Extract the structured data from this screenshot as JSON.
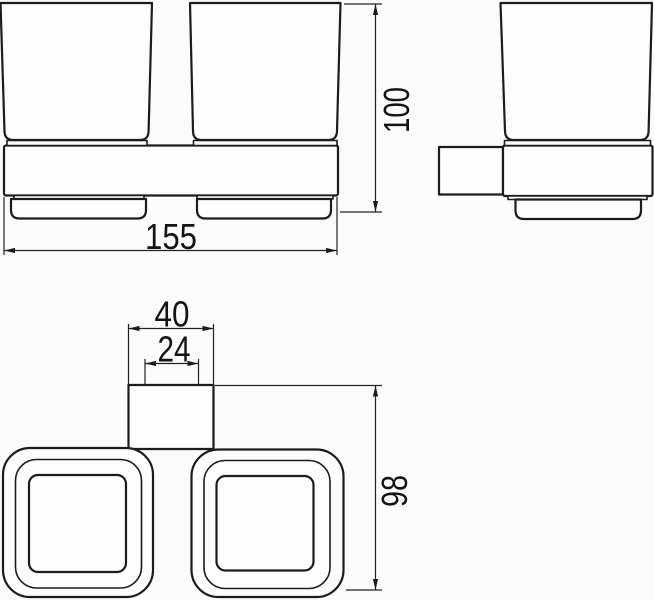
{
  "drawing": {
    "type": "technical-dimension-drawing",
    "subject": "double-tumbler-holder",
    "views": {
      "front_view": "top-left",
      "side_view": "top-right",
      "plan_view": "bottom"
    },
    "colors": {
      "background": "#fbfbfb",
      "object_line": "#1c1c1c",
      "dimension_line": "#222222",
      "text": "#141414"
    },
    "dimensions": {
      "overall_width_mm": "155",
      "overall_height_mm": "100",
      "bracket_width_mm": "40",
      "bracket_inner_width_mm": "24",
      "overall_depth_mm": "98"
    }
  }
}
